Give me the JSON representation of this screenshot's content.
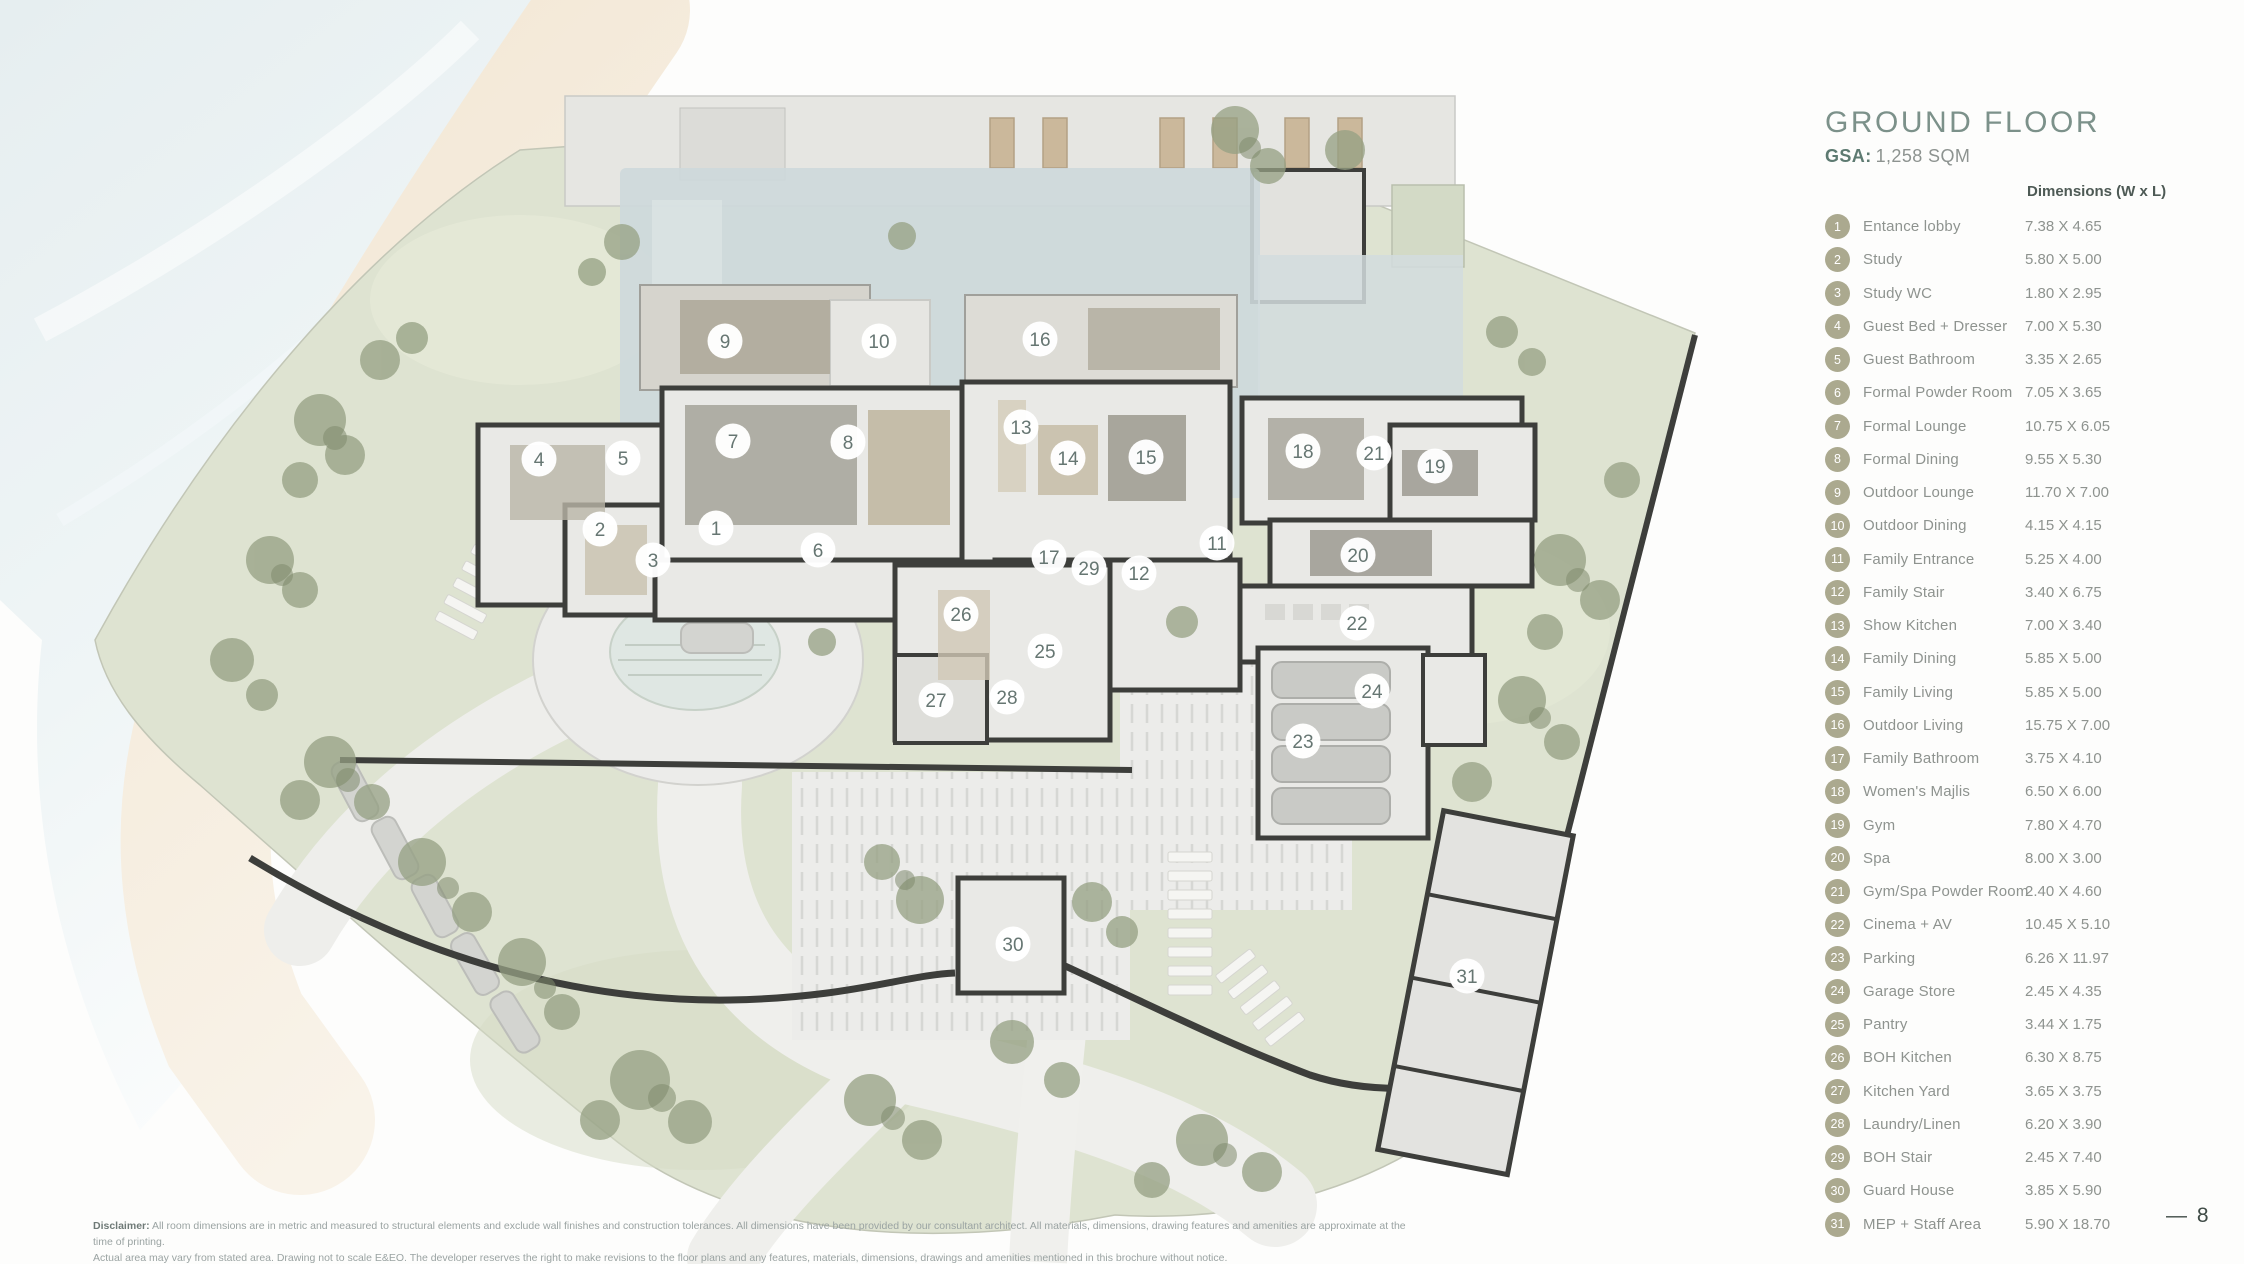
{
  "header": {
    "title": "GROUND FLOOR",
    "gsa_label": "GSA:",
    "gsa_value": "1,258 SQM",
    "dimensions_header": "Dimensions (W x L)"
  },
  "legend": {
    "rooms": [
      {
        "number": "1",
        "name": "Entance lobby",
        "dims": "7.38 X 4.65"
      },
      {
        "number": "2",
        "name": "Study",
        "dims": "5.80 X 5.00"
      },
      {
        "number": "3",
        "name": "Study WC",
        "dims": "1.80 X 2.95"
      },
      {
        "number": "4",
        "name": "Guest Bed + Dresser",
        "dims": "7.00 X 5.30"
      },
      {
        "number": "5",
        "name": "Guest Bathroom",
        "dims": "3.35 X 2.65"
      },
      {
        "number": "6",
        "name": "Formal Powder Room",
        "dims": "7.05 X 3.65"
      },
      {
        "number": "7",
        "name": "Formal Lounge",
        "dims": "10.75 X 6.05"
      },
      {
        "number": "8",
        "name": "Formal Dining",
        "dims": "9.55 X 5.30"
      },
      {
        "number": "9",
        "name": "Outdoor Lounge",
        "dims": "11.70 X 7.00"
      },
      {
        "number": "10",
        "name": "Outdoor Dining",
        "dims": "4.15 X 4.15"
      },
      {
        "number": "11",
        "name": "Family Entrance",
        "dims": "5.25 X 4.00"
      },
      {
        "number": "12",
        "name": "Family Stair",
        "dims": "3.40 X 6.75"
      },
      {
        "number": "13",
        "name": "Show Kitchen",
        "dims": "7.00 X 3.40"
      },
      {
        "number": "14",
        "name": "Family Dining",
        "dims": "5.85 X 5.00"
      },
      {
        "number": "15",
        "name": "Family Living",
        "dims": "5.85 X 5.00"
      },
      {
        "number": "16",
        "name": "Outdoor Living",
        "dims": "15.75 X 7.00"
      },
      {
        "number": "17",
        "name": "Family Bathroom",
        "dims": "3.75 X 4.10"
      },
      {
        "number": "18",
        "name": "Women's Majlis",
        "dims": "6.50 X 6.00"
      },
      {
        "number": "19",
        "name": "Gym",
        "dims": "7.80 X 4.70"
      },
      {
        "number": "20",
        "name": "Spa",
        "dims": "8.00 X 3.00"
      },
      {
        "number": "21",
        "name": "Gym/Spa Powder Room",
        "dims": "2.40 X 4.60"
      },
      {
        "number": "22",
        "name": "Cinema + AV",
        "dims": "10.45 X 5.10"
      },
      {
        "number": "23",
        "name": "Parking",
        "dims": "6.26 X 11.97"
      },
      {
        "number": "24",
        "name": "Garage Store",
        "dims": "2.45 X 4.35"
      },
      {
        "number": "25",
        "name": "Pantry",
        "dims": "3.44 X 1.75"
      },
      {
        "number": "26",
        "name": "BOH Kitchen",
        "dims": "6.30 X 8.75"
      },
      {
        "number": "27",
        "name": "Kitchen Yard",
        "dims": "3.65 X 3.75"
      },
      {
        "number": "28",
        "name": "Laundry/Linen",
        "dims": "6.20 X 3.90"
      },
      {
        "number": "29",
        "name": "BOH Stair",
        "dims": "2.45 X 7.40"
      },
      {
        "number": "30",
        "name": "Guard House",
        "dims": "3.85 X 5.90"
      },
      {
        "number": "31",
        "name": "MEP + Staff Area",
        "dims": "5.90 X 18.70"
      }
    ]
  },
  "plan": {
    "markers": [
      {
        "number": "1",
        "x": 716,
        "y": 528
      },
      {
        "number": "2",
        "x": 600,
        "y": 529
      },
      {
        "number": "3",
        "x": 653,
        "y": 560
      },
      {
        "number": "4",
        "x": 539,
        "y": 459
      },
      {
        "number": "5",
        "x": 623,
        "y": 458
      },
      {
        "number": "6",
        "x": 818,
        "y": 550
      },
      {
        "number": "7",
        "x": 733,
        "y": 441
      },
      {
        "number": "8",
        "x": 848,
        "y": 442
      },
      {
        "number": "9",
        "x": 725,
        "y": 341
      },
      {
        "number": "10",
        "x": 879,
        "y": 341
      },
      {
        "number": "11",
        "x": 1217,
        "y": 543
      },
      {
        "number": "12",
        "x": 1139,
        "y": 573
      },
      {
        "number": "13",
        "x": 1021,
        "y": 427
      },
      {
        "number": "14",
        "x": 1068,
        "y": 458
      },
      {
        "number": "15",
        "x": 1146,
        "y": 457
      },
      {
        "number": "16",
        "x": 1040,
        "y": 339
      },
      {
        "number": "17",
        "x": 1049,
        "y": 557
      },
      {
        "number": "18",
        "x": 1303,
        "y": 451
      },
      {
        "number": "19",
        "x": 1435,
        "y": 466
      },
      {
        "number": "20",
        "x": 1358,
        "y": 555
      },
      {
        "number": "21",
        "x": 1374,
        "y": 453
      },
      {
        "number": "22",
        "x": 1357,
        "y": 623
      },
      {
        "number": "23",
        "x": 1303,
        "y": 741
      },
      {
        "number": "24",
        "x": 1372,
        "y": 691
      },
      {
        "number": "25",
        "x": 1045,
        "y": 651
      },
      {
        "number": "26",
        "x": 961,
        "y": 614
      },
      {
        "number": "27",
        "x": 936,
        "y": 700
      },
      {
        "number": "28",
        "x": 1007,
        "y": 697
      },
      {
        "number": "29",
        "x": 1089,
        "y": 568
      },
      {
        "number": "30",
        "x": 1013,
        "y": 944
      },
      {
        "number": "31",
        "x": 1467,
        "y": 976
      }
    ]
  },
  "footer": {
    "disclaimer_label": "Disclaimer:",
    "disclaimer_line1": "All room dimensions are in metric and measured to structural elements and exclude wall finishes and construction tolerances. All dimensions have been provided by our consultant architect. All materials, dimensions, drawing features and amenities are approximate at the time of printing.",
    "disclaimer_line2": "Actual area may vary from stated area. Drawing not to scale E&EO. The developer reserves the right to make revisions to the floor plans and any features, materials, dimensions, drawings and amenities mentioned in this brochure without notice.",
    "page_number": "— 8"
  },
  "colors": {
    "accent_sage": "#7c918a",
    "legend_circle": "#aba98f",
    "marker_number": "#667672",
    "site_green": "#dee3d1",
    "pool_blue": "#cdd8db",
    "wall_dark": "#3d3e3b",
    "sand": "#f2e6d3",
    "sea": "#e6eef0"
  }
}
